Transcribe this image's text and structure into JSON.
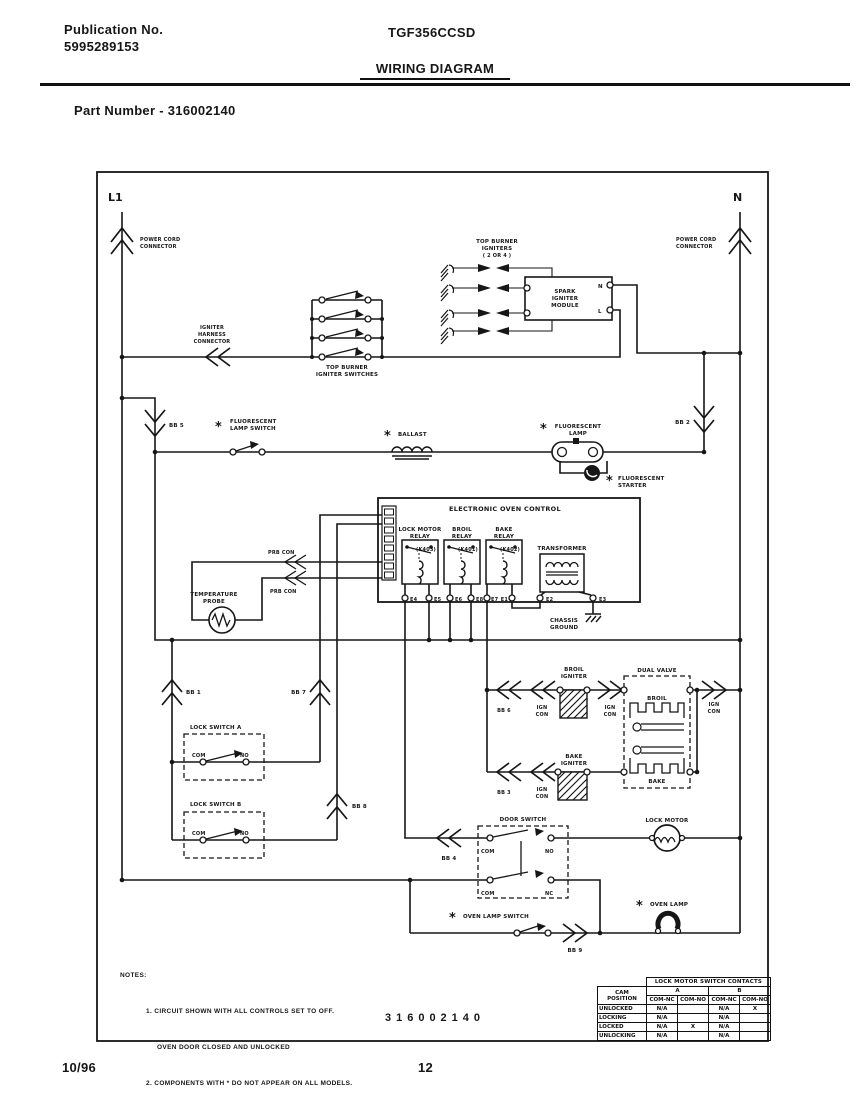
{
  "header": {
    "publication_label": "Publication No.",
    "publication_number": "5995289153",
    "model": "TGF356CCSD",
    "title": "WIRING DIAGRAM",
    "part_number": "Part Number - 316002140"
  },
  "diagram": {
    "number": "316002140",
    "l1": "L1",
    "n": "N",
    "labels": {
      "star": "*",
      "power_cord": [
        "POWER CORD",
        "CONNECTOR"
      ],
      "igniter_harness": [
        "IGNITER",
        "HARNESS",
        "CONNECTOR"
      ],
      "top_burner_igniters": [
        "TOP BURNER",
        "IGNITERS",
        "( 2 OR 4 )"
      ],
      "spark_module": [
        "SPARK",
        "IGNITER",
        "MODULE"
      ],
      "module_n": "N",
      "module_l": "L",
      "top_burner_switches": [
        "TOP BURNER",
        "IGNITER SWITCHES"
      ],
      "fluorescent_lamp_switch": [
        "FLUORESCENT",
        "LAMP SWITCH"
      ],
      "ballast": "BALLAST",
      "fluorescent_lamp": [
        "FLUORESCENT",
        "LAMP"
      ],
      "fluorescent_starter": [
        "FLUORESCENT",
        "STARTER"
      ],
      "eoc": "ELECTRONIC OVEN CONTROL",
      "lock_motor_relay": [
        "LOCK MOTOR",
        "RELAY"
      ],
      "k403": "(K403)",
      "broil_relay": [
        "BROIL",
        "RELAY"
      ],
      "k401": "(K401)",
      "bake_relay": [
        "BAKE",
        "RELAY"
      ],
      "k402": "(K402)",
      "transformer": "TRANSFORMER",
      "chassis_ground": [
        "CHASSIS",
        "GROUND"
      ],
      "e1": "E1",
      "e2": "E2",
      "e3": "E3",
      "e4": "E4",
      "e5": "E5",
      "e6": "E6",
      "e7": "E7",
      "e8": "E8",
      "prb_con": "PRB CON",
      "temperature_probe": [
        "TEMPERATURE",
        "PROBE"
      ],
      "lock_switch_a": "LOCK SWITCH A",
      "lock_switch_b": "LOCK SWITCH B",
      "com": "COM",
      "no": "NO",
      "nc": "NC",
      "door_switch": "DOOR SWITCH",
      "lock_motor": "LOCK MOTOR",
      "broil_igniter": [
        "BROIL",
        "IGNITER"
      ],
      "bake_igniter": [
        "BAKE",
        "IGNITER"
      ],
      "ign_con": [
        "IGN",
        "CON"
      ],
      "dual_valve": "DUAL VALVE",
      "broil": "BROIL",
      "bake": "BAKE",
      "oven_lamp_switch": "OVEN LAMP SWITCH",
      "oven_lamp": "OVEN LAMP",
      "bb1": "BB 1",
      "bb2": "BB 2",
      "bb3": "BB 3",
      "bb4": "BB 4",
      "bb5": "BB 5",
      "bb6": "BB 6",
      "bb7": "BB 7",
      "bb8": "BB 8",
      "bb9": "BB 9"
    },
    "notes": {
      "heading": "NOTES:",
      "line1": "1. CIRCUIT SHOWN WITH ALL CONTROLS SET TO OFF.",
      "line2": "OVEN DOOR CLOSED AND UNLOCKED",
      "line3": "2. COMPONENTS WITH * DO NOT APPEAR ON ALL MODELS."
    }
  },
  "lock_table": {
    "title": "LOCK MOTOR SWITCH CONTACTS",
    "cam_header": [
      "CAM",
      "POSITION"
    ],
    "group_a": "A",
    "group_b": "B",
    "contact_headers": [
      "COM-NC",
      "COM-NO",
      "COM-NC",
      "COM-NO"
    ],
    "rows": [
      {
        "name": "UNLOCKED",
        "a_nc": "N/A",
        "a_no": "",
        "b_nc": "N/A",
        "b_no": "X"
      },
      {
        "name": "LOCKING",
        "a_nc": "N/A",
        "a_no": "",
        "b_nc": "N/A",
        "b_no": ""
      },
      {
        "name": "LOCKED",
        "a_nc": "N/A",
        "a_no": "X",
        "b_nc": "N/A",
        "b_no": ""
      },
      {
        "name": "UNLOCKING",
        "a_nc": "N/A",
        "a_no": "",
        "b_nc": "N/A",
        "b_no": ""
      }
    ]
  },
  "footer": {
    "date": "10/96",
    "page": "12"
  }
}
